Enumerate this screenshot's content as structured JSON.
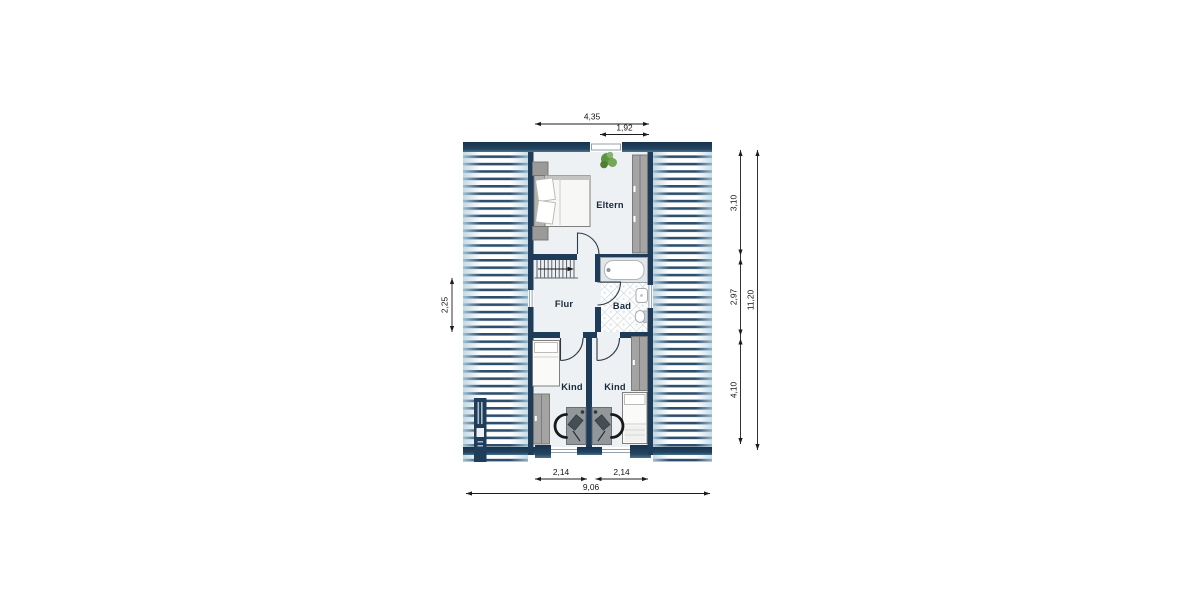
{
  "floor_plan": {
    "rooms": [
      {
        "name": "Eltern"
      },
      {
        "name": "Flur"
      },
      {
        "name": "Bad"
      },
      {
        "name": "Kind"
      },
      {
        "name": "Kind"
      }
    ],
    "dimensions": {
      "top": [
        "4,35",
        "1,92"
      ],
      "right": [
        "3,10",
        "2,97",
        "4,10",
        "11,20"
      ],
      "left": [
        "2,25"
      ],
      "bottom": [
        "2,14",
        "2,14",
        "9,06"
      ]
    },
    "symbols": {
      "double_bed": "double-bed-icon",
      "single_bed": "single-bed-icon",
      "nightstand": "nightstand-icon",
      "wardrobe": "wardrobe-icon",
      "plant": "plant-icon",
      "stairs": "stairs-icon",
      "bathtub": "bathtub-icon",
      "washbasin": "washbasin-icon",
      "toilet": "toilet-icon",
      "desk": "desk-icon",
      "chair": "chair-icon",
      "door_swing": "door-swing-icon"
    },
    "colors": {
      "wall_navy": "#1e3c5a",
      "roof_stripe": "#2d4e6c",
      "roof_tint": "#b7d3e2",
      "floor": "#edf1f4",
      "tile_line": "#c9ced4",
      "furniture_gray": "#a5a5a3",
      "bed_white": "#f7f7f5",
      "plant_green": "#5f943f",
      "dimension_text": "#141414",
      "label_text": "#17293c"
    }
  }
}
